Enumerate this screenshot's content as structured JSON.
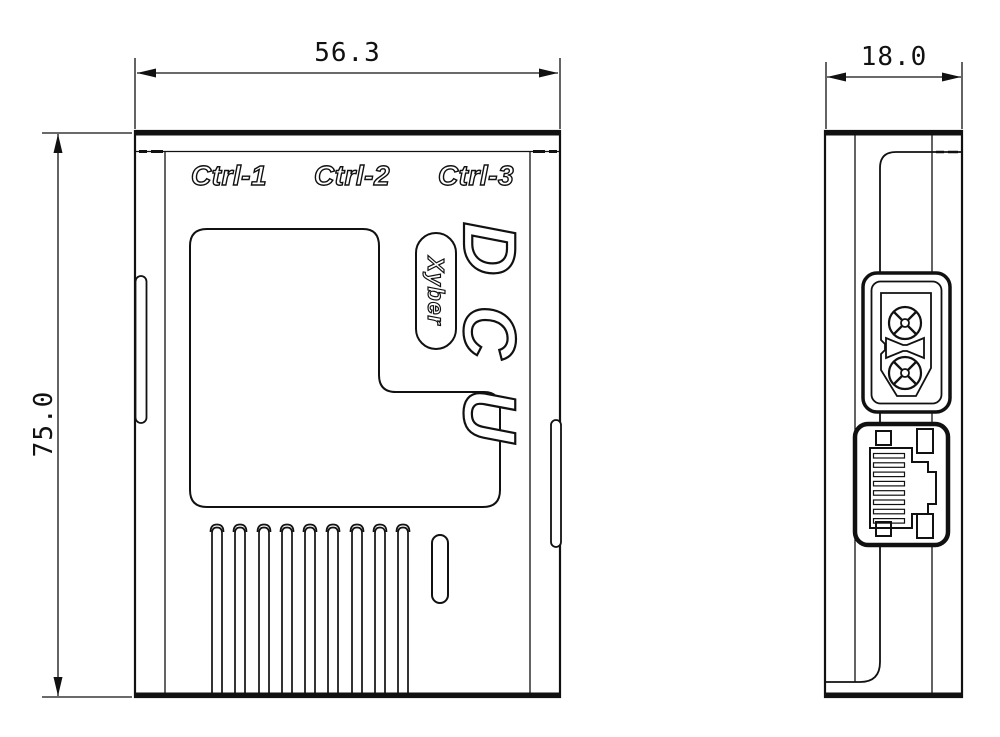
{
  "page": {
    "background": "#ffffff",
    "line_color": "#111111"
  },
  "views": {
    "front": {
      "width_dim": "56.3",
      "height_dim": "75.0",
      "labels": {
        "ports": [
          "Ctrl-1",
          "Ctrl-2",
          "Ctrl-3"
        ],
        "product": "DCU",
        "brand": "Xyber"
      }
    },
    "side": {
      "depth_dim": "18.0"
    }
  }
}
